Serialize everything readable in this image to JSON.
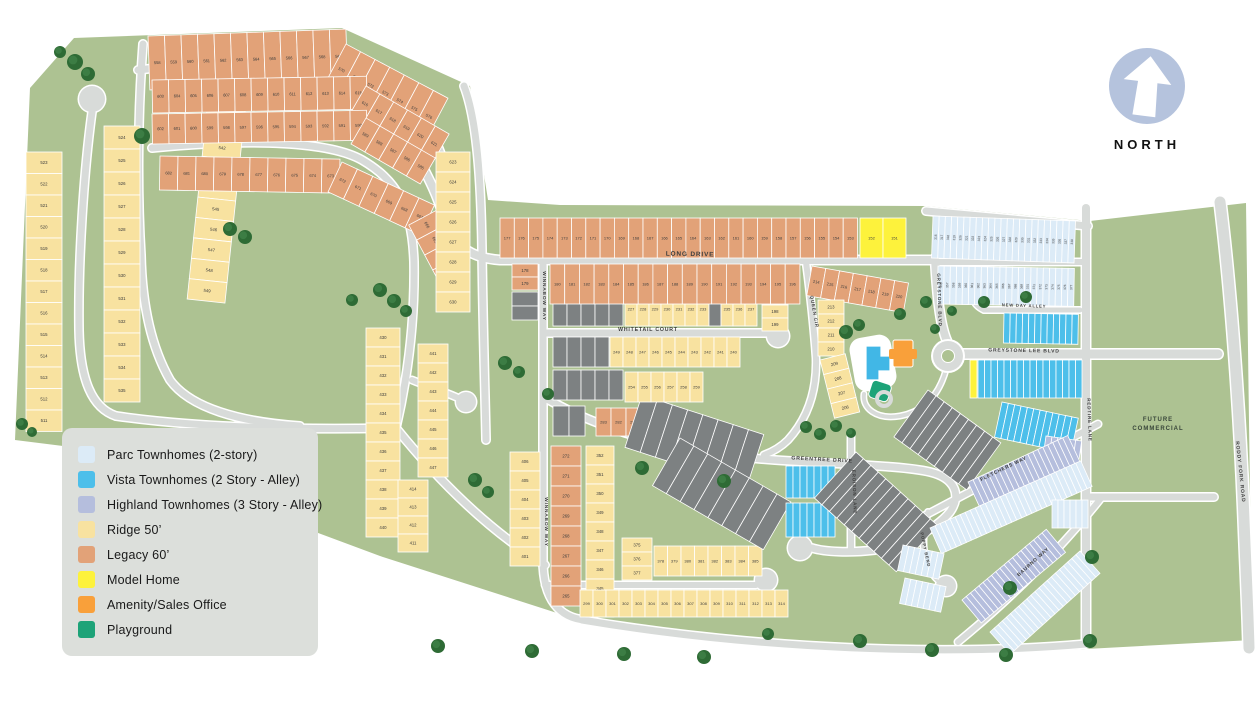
{
  "legend": {
    "items": [
      {
        "label": "Parc Townhomes (2-story)",
        "color": "#dcebf7"
      },
      {
        "label": "Vista Townhomes (2 Story - Alley)",
        "color": "#4dbfea"
      },
      {
        "label": "Highland Townhomes (3 Story - Alley)",
        "color": "#b5bedd"
      },
      {
        "label": "Ridge 50’",
        "color": "#f8e2a0"
      },
      {
        "label": "Legacy 60’",
        "color": "#e2a278"
      },
      {
        "label": "Model Home",
        "color": "#fdf23c"
      },
      {
        "label": "Amenity/Sales Office",
        "color": "#f9a03a"
      },
      {
        "label": "Playground",
        "color": "#1da378"
      }
    ]
  },
  "north": {
    "label": "NORTH",
    "circle_color": "#b5c3dd"
  },
  "areas": {
    "future_commercial_line1": "FUTURE",
    "future_commercial_line2": "COMMERCIAL"
  },
  "map": {
    "colors": {
      "green": "#adc292",
      "road": "#d8dbd9",
      "ridge": "#f8e2a0",
      "legacy": "#e2a278",
      "parc": "#dcebf7",
      "vista": "#4dbfea",
      "highland": "#b5bedd",
      "model": "#fdf23c",
      "amenity": "#f9a03a",
      "playground": "#1da378",
      "gray": "#7d8182",
      "tree": "#2e6b35",
      "tree2": "#3c7d44",
      "num": "#3c3c3c",
      "label": "#3e3e3e"
    },
    "parcels": [
      {
        "f": "green",
        "d": "M 30,88 L 74,38 L 342,28 L 470,86 L 488,200 L 560,205 L 925,206 L 1090,221 L 1246,203 L 1252,640 L 1086,649 C 950,658 760,652 585,622 L 380,556 L 95,450 L 15,440 Z"
      }
    ],
    "roads": [
      {
        "d": "M 413,148 C 425,172 436,190 443,215 C 452,245 470,258 500,260 L 935,260",
        "w": 8
      },
      {
        "d": "M 138,70 C 240,58 330,60 372,80 C 406,96 430,118 443,160",
        "w": 7
      },
      {
        "d": "M 152,148 C 255,138 330,142 362,160 C 396,180 412,205 414,262 C 415,320 408,376 396,428",
        "w": 7
      },
      {
        "d": "M 464,86 C 477,120 481,180 482,250 C 483,330 485,390 486,440",
        "w": 7
      },
      {
        "d": "M 116,416 C 200,428 300,430 396,428",
        "w": 7
      },
      {
        "d": "M 92,112 C 84,170 78,260 79,330 C 80,380 92,408 116,416",
        "w": 7
      },
      {
        "d": "M 143,44 C 138,110 137,190 141,255 C 142,300 150,345 170,380 C 190,408 240,422 300,426",
        "w": 7
      },
      {
        "d": "M 396,428 C 430,470 480,525 545,565",
        "w": 7
      },
      {
        "d": "M 412,380 C 432,388 450,394 458,398",
        "w": 6
      },
      {
        "d": "M 543,262 L 543,560 C 543,600 560,618 585,620",
        "w": 7
      },
      {
        "d": "M 543,333 L 768,333",
        "w": 7
      },
      {
        "d": "M 545,585 L 756,585",
        "w": 6
      },
      {
        "d": "M 806,262 C 811,300 814,330 816,358 C 817,390 808,418 788,440 C 780,448 772,452 764,455",
        "w": 6
      },
      {
        "d": "M 935,258 C 937,295 940,325 947,341",
        "w": 8
      },
      {
        "d": "M 938,262 L 1084,262",
        "w": 6
      },
      {
        "d": "M 926,211 L 1088,226",
        "w": 7
      },
      {
        "d": "M 984,310 L 1080,310",
        "w": 5
      },
      {
        "d": "M 984,310 C 973,305 969,294 974,284",
        "w": 5
      },
      {
        "d": "M 962,354 L 1218,354",
        "w": 9
      },
      {
        "d": "M 1086,208 L 1086,642",
        "w": 8
      },
      {
        "d": "M 1086,497 L 1214,497",
        "w": 7
      },
      {
        "d": "M 1220,202 C 1232,300 1240,420 1244,520 C 1246,570 1248,610 1249,648",
        "w": 11
      },
      {
        "d": "M 582,620 C 760,650 950,656 1086,644",
        "w": 7
      },
      {
        "d": "M 545,398 C 620,440 700,455 775,460 C 855,465 905,466 930,472 C 955,478 962,495 950,512 C 935,530 905,545 875,550 C 850,553 825,552 812,548",
        "w": 7
      },
      {
        "d": "M 851,436 L 851,548",
        "w": 6
      },
      {
        "d": "M 924,516 Q 1015,468 1098,424",
        "w": 6
      },
      {
        "d": "M 958,642 Q 1040,575 1102,497",
        "w": 6
      },
      {
        "d": "M 928,512 C 920,540 922,565 938,580",
        "w": 5
      },
      {
        "d": "M 946,370 C 938,398 922,412 900,416 C 876,420 862,408 864,394",
        "w": 4
      }
    ],
    "bulbs": [
      [
        92,
        99,
        13
      ],
      [
        466,
        402,
        10
      ],
      [
        778,
        336,
        11
      ],
      [
        766,
        580,
        11
      ],
      [
        800,
        548,
        12
      ],
      [
        946,
        586,
        10
      ],
      [
        976,
        293,
        8
      ]
    ],
    "roundabout": {
      "x": 948,
      "y": 356,
      "r": 15
    },
    "groups": [
      {
        "k": "v",
        "x": 26,
        "y": 152,
        "n": 13,
        "w": 36,
        "h": 21.5,
        "f": "ridge",
        "s": 523,
        "st": -1
      },
      {
        "k": "v",
        "x": 104,
        "y": 126,
        "n": 12,
        "w": 36,
        "h": 23,
        "f": "ridge",
        "s": 524,
        "st": 1
      },
      {
        "k": "v",
        "x": 215,
        "y": 34,
        "r": 6,
        "n": 13,
        "w": 38,
        "h": 20.5,
        "f": "ridge",
        "s": 537,
        "st": 1
      },
      {
        "k": "h",
        "x": 148,
        "y": 36,
        "r": -2,
        "n": 12,
        "w": 16.5,
        "h": 54,
        "f": "legacy",
        "s": 558,
        "st": 1
      },
      {
        "k": "h",
        "x": 346,
        "y": 44,
        "r": 28,
        "n": 7,
        "w": 16.5,
        "h": 50,
        "f": "legacy",
        "s": 570,
        "st": 1
      },
      {
        "k": "h",
        "x": 152,
        "y": 80,
        "r": -1,
        "n": 13,
        "w": 16.5,
        "h": 33,
        "f": "legacy",
        "s": 603,
        "st": 1
      },
      {
        "k": "h",
        "x": 366,
        "y": 86,
        "r": 30,
        "n": 6,
        "w": 16,
        "h": 32,
        "f": "legacy",
        "s": 616,
        "st": 1
      },
      {
        "k": "h",
        "x": 152,
        "y": 114,
        "r": -1,
        "n": 13,
        "w": 16.5,
        "h": 30,
        "f": "legacy",
        "s": 602,
        "st": -1
      },
      {
        "k": "h",
        "x": 366,
        "y": 118,
        "r": 30,
        "n": 5,
        "w": 16,
        "h": 30,
        "f": "legacy",
        "s": 589,
        "st": -1
      },
      {
        "k": "h",
        "x": 160,
        "y": 156,
        "r": 1,
        "n": 10,
        "w": 18,
        "h": 34,
        "f": "legacy",
        "s": 682,
        "st": -1
      },
      {
        "k": "h",
        "x": 342,
        "y": 162,
        "r": 25,
        "n": 6,
        "w": 17,
        "h": 33,
        "f": "legacy",
        "s": 672,
        "st": -1
      },
      {
        "k": "h",
        "x": 437,
        "y": 210,
        "r": 62,
        "n": 4,
        "w": 17,
        "h": 32,
        "f": "legacy",
        "s": 666,
        "st": -1
      },
      {
        "k": "v",
        "x": 436,
        "y": 152,
        "n": 8,
        "w": 34,
        "h": 20,
        "f": "ridge",
        "s": 623,
        "st": 1
      },
      {
        "k": "v",
        "x": 366,
        "y": 328,
        "n": 11,
        "w": 34,
        "h": 19,
        "f": "ridge",
        "s": 430,
        "st": 1
      },
      {
        "k": "v",
        "x": 418,
        "y": 344,
        "n": 7,
        "w": 30,
        "h": 19,
        "f": "ridge",
        "s": 441,
        "st": 1
      },
      {
        "k": "v",
        "x": 398,
        "y": 480,
        "n": 4,
        "w": 30,
        "h": 18,
        "f": "ridge",
        "s": 414,
        "st": -1
      },
      {
        "k": "v",
        "x": 510,
        "y": 452,
        "n": 6,
        "w": 30,
        "h": 19,
        "f": "ridge",
        "s": 406,
        "st": -1
      },
      {
        "k": "v",
        "x": 551,
        "y": 446,
        "n": 8,
        "w": 30,
        "h": 20,
        "f": "legacy",
        "s": 272,
        "st": -1
      },
      {
        "k": "v",
        "x": 586,
        "y": 446,
        "n": 9,
        "w": 28,
        "h": 19,
        "f": "ridge",
        "s": 352,
        "st": -1
      },
      {
        "k": "v",
        "x": 622,
        "y": 538,
        "n": 3,
        "w": 30,
        "h": 14,
        "f": "ridge",
        "s": 375,
        "st": 1
      },
      {
        "k": "h",
        "x": 654,
        "y": 546,
        "n": 8,
        "w": 13.5,
        "h": 30,
        "f": "ridge",
        "s": 378,
        "st": 1
      },
      {
        "k": "h",
        "x": 580,
        "y": 590,
        "n": 16,
        "w": 13,
        "h": 27,
        "f": "ridge",
        "s": 299,
        "st": 1
      },
      {
        "k": "h",
        "x": 596,
        "y": 408,
        "n": 3,
        "w": 15,
        "h": 28,
        "f": "legacy",
        "s": 283,
        "st": -1
      },
      {
        "k": "h",
        "x": 553,
        "y": 406,
        "n": 2,
        "w": 16,
        "h": 30,
        "f": "gray"
      },
      {
        "k": "h",
        "x": 643,
        "y": 409,
        "r": 8,
        "n": 4,
        "w": 17,
        "h": 30,
        "f": "gray"
      },
      {
        "k": "h",
        "x": 642,
        "y": 395,
        "r": 18,
        "n": 8,
        "w": 16,
        "h": 55,
        "f": "gray"
      },
      {
        "k": "h",
        "x": 680,
        "y": 438,
        "r": 30,
        "n": 8,
        "w": 16,
        "h": 55,
        "f": "gray"
      },
      {
        "k": "h",
        "x": 553,
        "y": 292,
        "n": 5,
        "w": 14,
        "h": 34,
        "f": "gray"
      },
      {
        "k": "h",
        "x": 625,
        "y": 292,
        "n": 11,
        "w": 12,
        "h": 34,
        "f": "ridge",
        "s": 227,
        "st": 1,
        "gi": [
          7
        ]
      },
      {
        "k": "v",
        "x": 762,
        "y": 292,
        "n": 3,
        "w": 26,
        "h": 13,
        "f": "ridge",
        "s": 197,
        "st": 1
      },
      {
        "k": "h",
        "x": 553,
        "y": 337,
        "n": 4,
        "w": 14,
        "h": 30,
        "f": "gray"
      },
      {
        "k": "h",
        "x": 610,
        "y": 337,
        "n": 10,
        "w": 13,
        "h": 30,
        "f": "ridge",
        "s": 249,
        "st": -1
      },
      {
        "k": "h",
        "x": 553,
        "y": 370,
        "n": 5,
        "w": 14,
        "h": 30,
        "f": "gray"
      },
      {
        "k": "h",
        "x": 625,
        "y": 372,
        "n": 6,
        "w": 13,
        "h": 30,
        "f": "ridge",
        "s": 254,
        "st": 1
      },
      {
        "k": "h",
        "x": 812,
        "y": 266,
        "r": 10,
        "n": 7,
        "w": 14,
        "h": 30,
        "f": "legacy",
        "s": 214,
        "st": 1
      },
      {
        "k": "v",
        "x": 818,
        "y": 300,
        "n": 4,
        "w": 26,
        "h": 14,
        "f": "ridge",
        "s": 213,
        "st": -1
      },
      {
        "k": "v",
        "x": 820,
        "y": 360,
        "r": -14,
        "n": 4,
        "w": 26,
        "h": 15,
        "f": "ridge",
        "s": 209,
        "st": -1
      },
      {
        "k": "v",
        "x": 512,
        "y": 264,
        "n": 2,
        "w": 26,
        "h": 13,
        "f": "legacy",
        "s": 178,
        "st": 1
      },
      {
        "k": "v",
        "x": 512,
        "y": 292,
        "n": 2,
        "w": 26,
        "h": 14,
        "f": "gray"
      },
      {
        "k": "h",
        "x": 500,
        "y": 218,
        "n": 25,
        "w": 14.3,
        "h": 40,
        "f": "legacy",
        "s": 177,
        "st": -1
      },
      {
        "k": "h",
        "x": 860,
        "y": 218,
        "n": 2,
        "w": 23,
        "h": 40,
        "f": "model",
        "s": 152,
        "st": -1
      },
      {
        "k": "h",
        "x": 550,
        "y": 264,
        "n": 17,
        "w": 14.7,
        "h": 40,
        "f": "legacy",
        "s": 180,
        "st": 1
      },
      {
        "k": "h",
        "x": 933,
        "y": 216,
        "r": 2,
        "n": 23,
        "w": 6.2,
        "h": 42,
        "f": "parc",
        "s": 316,
        "st": 1,
        "nr": true
      },
      {
        "k": "h",
        "x": 938,
        "y": 266,
        "r": 1,
        "n": 22,
        "w": 6.2,
        "h": 38,
        "f": "parc",
        "s": 356,
        "st": 1,
        "nr": true
      },
      {
        "k": "h",
        "x": 1004,
        "y": 313,
        "r": 1,
        "n": 12,
        "w": 6.2,
        "h": 30,
        "f": "vista"
      },
      {
        "k": "h",
        "x": 978,
        "y": 360,
        "n": 16,
        "w": 6.5,
        "h": 38,
        "f": "vista"
      },
      {
        "k": "h",
        "x": 970,
        "y": 360,
        "n": 1,
        "w": 7,
        "h": 38,
        "f": "model"
      },
      {
        "k": "h",
        "x": 1002,
        "y": 402,
        "r": 12,
        "n": 12,
        "w": 6.5,
        "h": 36,
        "f": "vista"
      },
      {
        "k": "h",
        "x": 1046,
        "y": 436,
        "r": 8,
        "n": 6,
        "w": 6,
        "h": 32,
        "f": "highland",
        "mi": [
          3
        ]
      },
      {
        "k": "h",
        "x": 786,
        "y": 466,
        "n": 7,
        "w": 7,
        "h": 32,
        "f": "vista"
      },
      {
        "k": "h",
        "x": 786,
        "y": 503,
        "n": 7,
        "w": 7,
        "h": 34,
        "f": "vista"
      },
      {
        "k": "h",
        "x": 858,
        "y": 505,
        "r": -35,
        "n": 5,
        "w": 7,
        "h": 30,
        "f": "vista"
      },
      {
        "k": "h",
        "x": 928,
        "y": 390,
        "r": 36,
        "n": 9,
        "w": 10,
        "h": 58,
        "f": "gray"
      },
      {
        "k": "h",
        "x": 856,
        "y": 452,
        "r": 42,
        "n": 11,
        "w": 10,
        "h": 62,
        "f": "gray"
      },
      {
        "k": "h",
        "x": 968,
        "y": 482,
        "r": -25,
        "n": 20,
        "w": 5.5,
        "h": 30,
        "f": "highland"
      },
      {
        "k": "h",
        "x": 930,
        "y": 528,
        "r": -24,
        "n": 30,
        "w": 5.5,
        "h": 28,
        "f": "parc"
      },
      {
        "k": "h",
        "x": 962,
        "y": 600,
        "r": -40,
        "n": 20,
        "w": 5.5,
        "h": 30,
        "f": "highland"
      },
      {
        "k": "h",
        "x": 990,
        "y": 632,
        "r": -42,
        "n": 22,
        "w": 5.5,
        "h": 30,
        "f": "parc"
      },
      {
        "k": "h",
        "x": 1052,
        "y": 500,
        "n": 6,
        "w": 6,
        "h": 28,
        "f": "parc"
      },
      {
        "k": "h",
        "x": 903,
        "y": 545,
        "r": 12,
        "n": 7,
        "w": 6,
        "h": 26,
        "f": "parc"
      },
      {
        "k": "h",
        "x": 905,
        "y": 578,
        "r": 12,
        "n": 7,
        "w": 6,
        "h": 26,
        "f": "parc"
      }
    ],
    "trees": [
      [
        75,
        62,
        8
      ],
      [
        88,
        74,
        7
      ],
      [
        60,
        52,
        6
      ],
      [
        142,
        136,
        8
      ],
      [
        230,
        229,
        7
      ],
      [
        245,
        237,
        7
      ],
      [
        22,
        424,
        6
      ],
      [
        32,
        432,
        5
      ],
      [
        380,
        290,
        7
      ],
      [
        394,
        301,
        7
      ],
      [
        406,
        311,
        6
      ],
      [
        352,
        300,
        6
      ],
      [
        505,
        363,
        7
      ],
      [
        519,
        372,
        6
      ],
      [
        475,
        480,
        7
      ],
      [
        488,
        492,
        6
      ],
      [
        438,
        646,
        7
      ],
      [
        532,
        651,
        7
      ],
      [
        624,
        654,
        7
      ],
      [
        704,
        657,
        7
      ],
      [
        768,
        634,
        6
      ],
      [
        860,
        641,
        7
      ],
      [
        932,
        650,
        7
      ],
      [
        1006,
        655,
        7
      ],
      [
        1090,
        641,
        7
      ],
      [
        846,
        332,
        7
      ],
      [
        859,
        325,
        6
      ],
      [
        900,
        314,
        6
      ],
      [
        926,
        302,
        6
      ],
      [
        935,
        329,
        5
      ],
      [
        642,
        468,
        7
      ],
      [
        724,
        481,
        7
      ],
      [
        806,
        427,
        6
      ],
      [
        820,
        434,
        6
      ],
      [
        836,
        426,
        6
      ],
      [
        851,
        433,
        5
      ],
      [
        984,
        302,
        6
      ],
      [
        1026,
        297,
        6
      ],
      [
        952,
        311,
        5
      ],
      [
        1010,
        588,
        7
      ],
      [
        1092,
        557,
        7
      ],
      [
        548,
        394,
        6
      ]
    ],
    "street_labels": [
      {
        "t": "LONG DRIVE",
        "x": 690,
        "y": 256,
        "r": 1,
        "s": 6.5
      },
      {
        "t": "WINNABOW WAY",
        "x": 543,
        "y": 296,
        "r": 90,
        "s": 4.8
      },
      {
        "t": "WINNABOW WAY",
        "x": 545,
        "y": 522,
        "r": 90,
        "s": 4.8
      },
      {
        "t": "WHITETAIL COURT",
        "x": 648,
        "y": 331,
        "r": 0,
        "s": 5.2
      },
      {
        "t": "QUEEN CIR",
        "x": 813,
        "y": 312,
        "r": 80,
        "s": 4.6
      },
      {
        "t": "GREYSTONE BLVD",
        "x": 938,
        "y": 300,
        "r": 88,
        "s": 4.6
      },
      {
        "t": "NEW DAY ALLEY",
        "x": 1024,
        "y": 307,
        "r": 2,
        "s": 4.2
      },
      {
        "t": "GREYSTONE LEE BLVD",
        "x": 1024,
        "y": 352,
        "r": 1,
        "s": 5
      },
      {
        "t": "GREENTREE DRIVE",
        "x": 822,
        "y": 461,
        "r": 3,
        "s": 5.2
      },
      {
        "t": "EROISON LANE",
        "x": 853,
        "y": 492,
        "r": 88,
        "s": 4.6
      },
      {
        "t": "REDTIRE LANE",
        "x": 1088,
        "y": 420,
        "r": 88,
        "s": 4.6
      },
      {
        "t": "RODDY FORK ROAD",
        "x": 1239,
        "y": 472,
        "r": 84,
        "s": 5
      },
      {
        "t": "FLETCHERS WAY",
        "x": 1004,
        "y": 470,
        "r": -26,
        "s": 4.8
      },
      {
        "t": "BAURNO WAY",
        "x": 1034,
        "y": 563,
        "r": -42,
        "s": 4.8
      },
      {
        "t": "POPPY BEND",
        "x": 924,
        "y": 550,
        "r": 78,
        "s": 4.2
      }
    ],
    "future_commercial": {
      "x": 1158,
      "y": 421
    }
  }
}
